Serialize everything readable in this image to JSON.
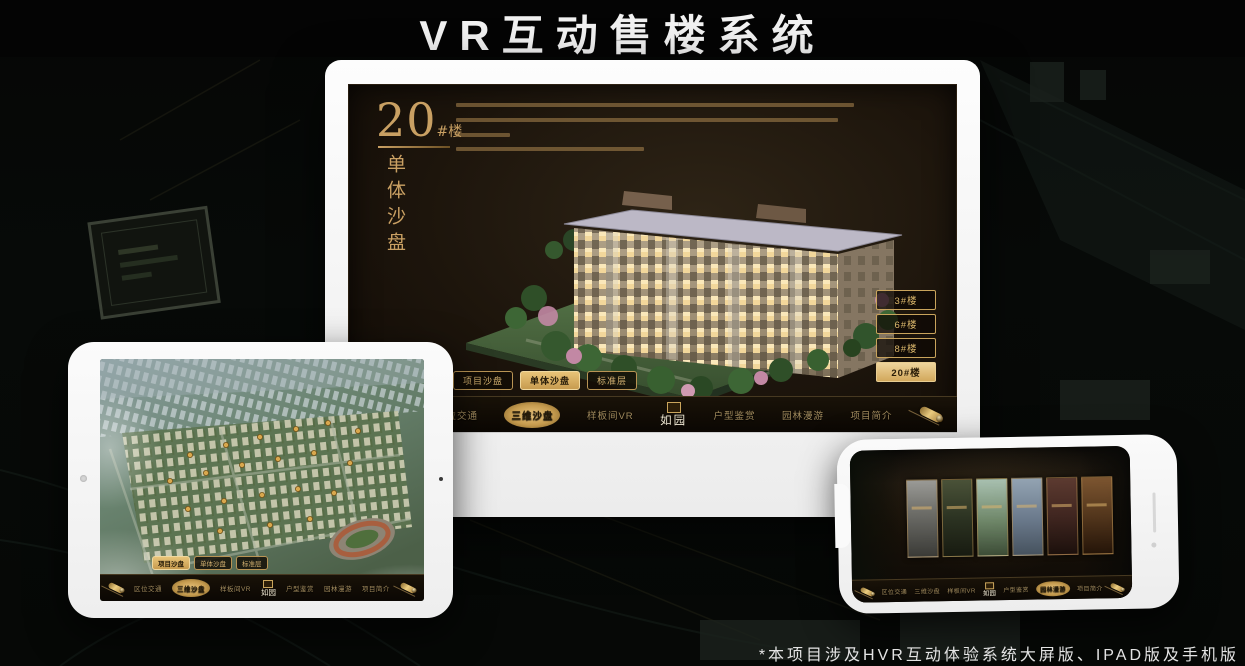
{
  "page": {
    "title": "VR互动售楼系统",
    "footnote": "*本项目涉及HVR互动体验系统大屏版、IPAD版及手机版"
  },
  "colors": {
    "gold": "#D2A85C",
    "gold_bright": "#E8C878",
    "gold_dark": "#7A5C24",
    "screen_bg": "#1D150C",
    "page_bg": "#060906",
    "selected_text": "#241A08",
    "title_text": "#F2F2F2"
  },
  "icons": {
    "scroll_left": "scroll-handle-icon",
    "scroll_right": "scroll-handle-icon",
    "logo_seal": "seal-icon",
    "tablet_camera": "front-camera",
    "phone_speaker": "speaker-slot"
  },
  "desktop": {
    "heading_number": "20",
    "heading_unit": "#楼",
    "heading_subtitle": "单体沙盘",
    "building_buttons": [
      {
        "label": "3#楼",
        "selected": false
      },
      {
        "label": "6#楼",
        "selected": false
      },
      {
        "label": "8#楼",
        "selected": false
      },
      {
        "label": "20#楼",
        "selected": true
      }
    ],
    "tabs": [
      {
        "label": "项目沙盘",
        "selected": false
      },
      {
        "label": "单体沙盘",
        "selected": true
      },
      {
        "label": "标准层",
        "selected": false
      }
    ],
    "nav": {
      "logo": "如园",
      "items": [
        {
          "label": "区位交通",
          "selected": false
        },
        {
          "label": "三维沙盘",
          "selected": true
        },
        {
          "label": "样板间VR",
          "selected": false
        },
        {
          "label": "户型鉴赏",
          "selected": false
        },
        {
          "label": "园林漫游",
          "selected": false
        },
        {
          "label": "项目简介",
          "selected": false
        }
      ]
    }
  },
  "tablet": {
    "tabs": [
      {
        "label": "项目沙盘",
        "selected": true
      },
      {
        "label": "单体沙盘",
        "selected": false
      },
      {
        "label": "标准层",
        "selected": false
      }
    ],
    "nav": {
      "logo": "如园",
      "items": [
        {
          "label": "区位交通",
          "selected": false
        },
        {
          "label": "三维沙盘",
          "selected": true
        },
        {
          "label": "样板间VR",
          "selected": false
        },
        {
          "label": "户型鉴赏",
          "selected": false
        },
        {
          "label": "园林漫游",
          "selected": false
        },
        {
          "label": "项目简介",
          "selected": false
        }
      ]
    }
  },
  "phone": {
    "nav": {
      "logo": "如园",
      "items": [
        {
          "label": "区位交通",
          "selected": false
        },
        {
          "label": "三维沙盘",
          "selected": false
        },
        {
          "label": "样板间VR",
          "selected": false
        },
        {
          "label": "户型鉴赏",
          "selected": false
        },
        {
          "label": "园林漫游",
          "selected": true
        },
        {
          "label": "项目简介",
          "selected": false
        }
      ]
    }
  }
}
